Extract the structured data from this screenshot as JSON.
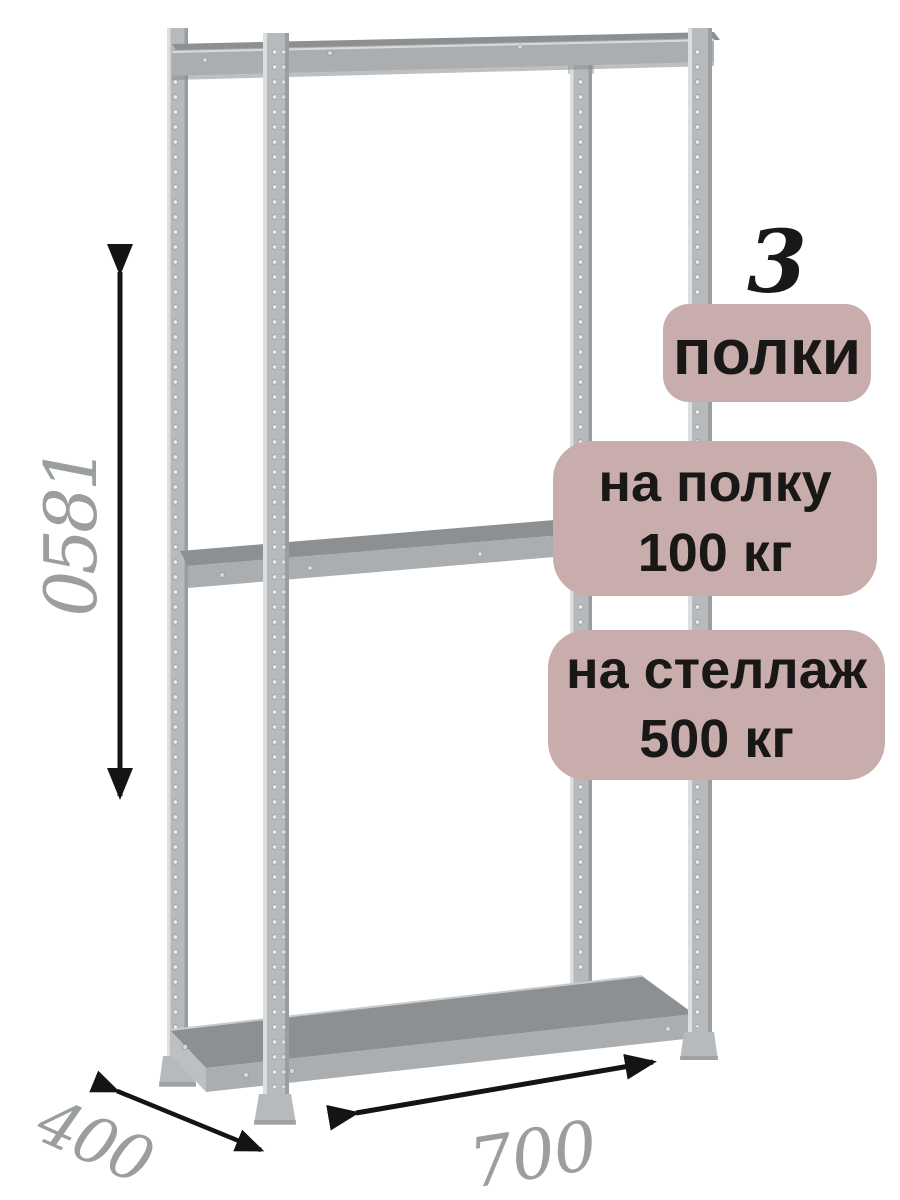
{
  "badges": {
    "shelf_count": {
      "number": "3",
      "label": "полки"
    },
    "per_shelf": {
      "line1": "на полку",
      "line2": "100 кг"
    },
    "per_rack": {
      "line1": "на стеллаж",
      "line2": "500 кг"
    }
  },
  "dimensions": {
    "height_mm": "1850",
    "depth_mm": "400",
    "width_mm": "700"
  },
  "icons": {
    "height_arrow": "double-headed-vertical-arrow",
    "depth_arrow": "double-headed-diagonal-arrow",
    "width_arrow": "double-headed-diagonal-arrow"
  },
  "colors": {
    "background": "#ffffff",
    "badge_bg": "#c9adad",
    "badge_text": "#1a1816",
    "dimension_text": "#9a9e9e",
    "arrow": "#141414",
    "metal_light": "#dcdfe0",
    "metal_mid": "#b6babc",
    "metal_dark": "#8f9395",
    "shelf_top": "#8c9092",
    "shelf_front": "#abaeb0"
  }
}
